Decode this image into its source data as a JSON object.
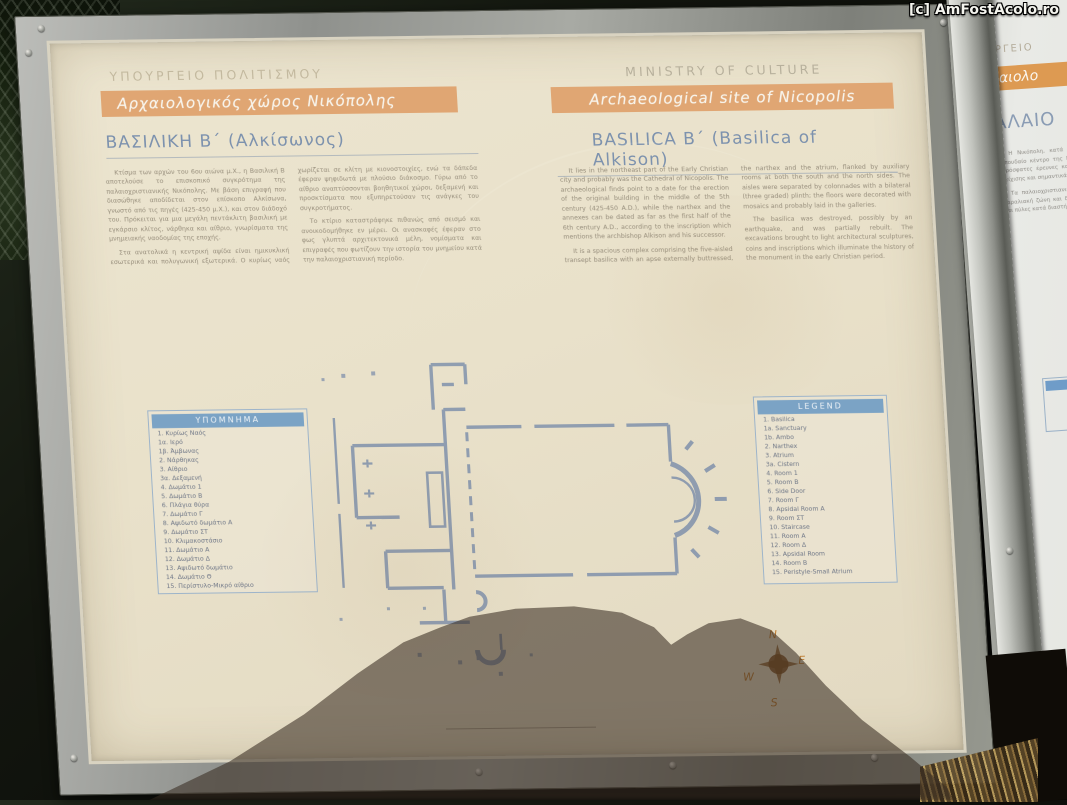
{
  "watermark": "[c] AmFostAcolo.ro",
  "compass": {
    "north": "N",
    "east": "E",
    "south": "S",
    "west": "W"
  },
  "board": {
    "greek": {
      "ministry": "ΥΠΟΥΡΓΕΙΟ ΠΟΛΙΤΙΣΜΟΥ",
      "banner": "Αρχαιολογικός χώρος Νικόπολης",
      "title": "ΒΑΣΙΛΙΚΗ Β΄ (Αλκίσωνος)",
      "paragraphs": [
        "Κτίσμα των αρχών του 6ου αιώνα μ.Χ., η Βασιλική Β αποτελούσε το επισκοπικό συγκρότημα της παλαιοχριστιανικής Νικόπολης. Με βάση επιγραφή που διασώθηκε αποδίδεται στον επίσκοπο Αλκίσωνα, γνωστό από τις πηγές (425-450 μ.Χ.), και στον διάδοχό του. Πρόκειται για μια μεγάλη πεντάκλιτη βασιλική με εγκάρσιο κλίτος, νάρθηκα και αίθριο, γνωρίσματα της μνημειακής ναοδομίας της εποχής.",
        "Στα ανατολικά η κεντρική αψίδα είναι ημικυκλική εσωτερικά και πολυγωνική εξωτερικά. Ο κυρίως ναός χωρίζεται σε κλίτη με κιονοστοιχίες, ενώ τα δάπεδα έφεραν ψηφιδωτά με πλούσιο διάκοσμο. Γύρω από το αίθριο αναπτύσσονται βοηθητικοί χώροι, δεξαμενή και προσκτίσματα που εξυπηρετούσαν τις ανάγκες του συγκροτήματος.",
        "Το κτίριο καταστράφηκε πιθανώς από σεισμό και ανοικοδομήθηκε εν μέρει. Οι ανασκαφές έφεραν στο φως γλυπτά αρχιτεκτονικά μέλη, νομίσματα και επιγραφές που φωτίζουν την ιστορία του μνημείου κατά την παλαιοχριστιανική περίοδο."
      ],
      "legend_header": "ΥΠΟΜΝΗΜΑ",
      "legend_items": [
        "1. Κυρίως Ναός",
        "1α. Ιερό",
        "1β. Άμβωνας",
        "2. Νάρθηκας",
        "3. Αίθριο",
        "3α. Δεξαμενή",
        "4. Δωμάτιο 1",
        "5. Δωμάτιο Β",
        "6. Πλάγια θύρα",
        "7. Δωμάτιο Γ",
        "8. Αψιδωτό δωμάτιο Α",
        "9. Δωμάτιο ΣΤ",
        "10. Κλιμακοστάσιο",
        "11. Δωμάτιο Α",
        "12. Δωμάτιο Δ",
        "13. Αψιδωτό δωμάτιο",
        "14. Δωμάτιο Θ",
        "15. Περίστυλο-Μικρό αίθριο"
      ]
    },
    "english": {
      "ministry": "MINISTRY OF CULTURE",
      "banner": "Archaeological site of Nicopolis",
      "title": "BASILICA B΄ (Basilica of Alkison)",
      "paragraphs": [
        "It lies in the northeast part of the Early Christian city and probably was the Cathedral of Nicopolis. The archaeological finds point to a date for the erection of the original building in the middle of the 5th century (425-450 A.D.), while the narthex and the annexes can be dated as far as the first half of the 6th century A.D., according to the inscription which mentions the archbishop Alkison and his successor.",
        "It is a spacious complex comprising the five-aisled transept basilica with an apse externally buttressed, the narthex and the atrium, flanked by auxiliary rooms at both the south and the north sides. The aisles were separated by colonnades with a bilateral (three graded) plinth; the floors were decorated with mosaics and probably laid in the galleries.",
        "The basilica was destroyed, possibly by an earthquake, and was partially rebuilt. The excavations brought to light architectural sculptures, coins and inscriptions which illuminate the history of the monument in the early Christian period."
      ],
      "legend_header": "LEGEND",
      "legend_items": [
        "1. Basilica",
        "1a. Sanctuary",
        "1b. Ambo",
        "2. Narthex",
        "3. Atrium",
        "3a. Cistern",
        "4. Room 1",
        "5. Room B",
        "6. Side Door",
        "7. Room Γ",
        "8. Apsidal Room A",
        "9. Room ΣΤ",
        "10. Staircase",
        "11. Room A",
        "12. Room Δ",
        "13. Apsidal Room",
        "14. Room B",
        "15. Peristyle-Small Atrium"
      ]
    }
  },
  "side_sign": {
    "ministry_fragment": "ΡΓΕΙΟ",
    "banner_fragment": "αιολο",
    "title_fragment": "ΑΛΑΙΟ",
    "paragraphs": [
      "Η Νικόπολη, κατά τους αιώνες της ακμής της, υπήρξε σπουδαίο κέντρο της Ρωμαϊκής και πρωτοβυζαντινής εποχής. Πρόσφατες έρευνες και ανασκαφές αποκάλυψαν τμήματα της τείχισης και σημαντικά δημόσια κτίρια της πόλης.",
      "Τα παλαιοχριστιανικά τείχη (5ος αι. μ.Χ.) περιέβαλαν την παραλιακή ζώνη και διασώζονται σε μεγάλο ύψος, με πύργους και πύλες κατά διαστήματα."
    ]
  },
  "colors": {
    "banner_orange": "#e0a673",
    "side_banner_orange": "#dd9a52",
    "title_blue": "#7d92ae",
    "legend_blue": "#7ba3c5",
    "plan_blue": "#7589a8",
    "board_cream": "#e9e2cc",
    "compass_orange": "#bf7c31"
  }
}
